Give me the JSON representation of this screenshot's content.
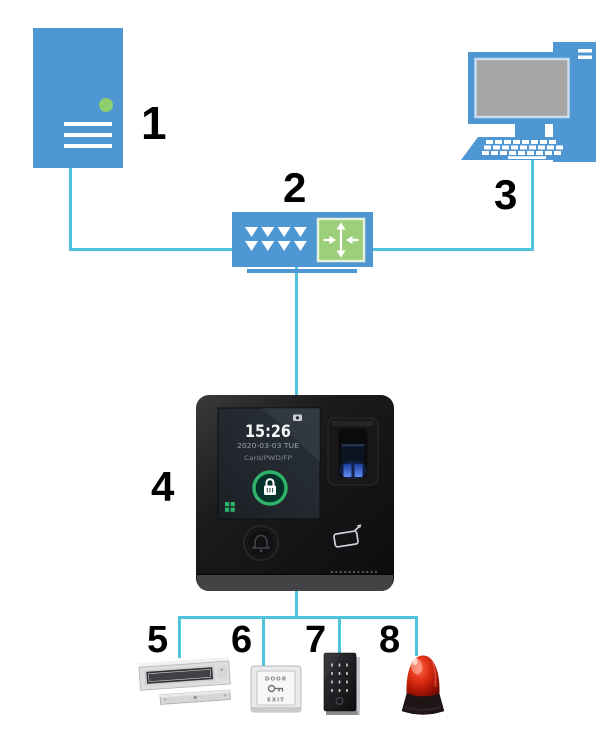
{
  "canvas": {
    "width": 608,
    "height": 733,
    "background_color": "#ffffff"
  },
  "palette": {
    "device_blue": "#4e97d3",
    "connector_cyan": "#4fc3dc",
    "accent_green": "#8fce6e",
    "switch_module_green": "#9ccf7a",
    "monitor_screen_gray": "#a6a6a6",
    "terminal_body_black": "#151517",
    "terminal_lock_ring_green": "#2eb46a",
    "fingerprint_glow_blue": "#4a7cf0",
    "siren_red": "#d42414",
    "number_label_color": "#000000"
  },
  "nodes": {
    "server": {
      "label": "1",
      "type": "server"
    },
    "switch": {
      "label": "2",
      "type": "network-switch"
    },
    "computer": {
      "label": "3",
      "type": "desktop-computer"
    },
    "terminal": {
      "label": "4",
      "type": "access-control-terminal",
      "screen": {
        "time": "15:26",
        "date": "2020-03-03  TUE",
        "auth_modes": "Card/PWD/FP"
      }
    },
    "lock": {
      "label": "5",
      "type": "magnetic-lock"
    },
    "exit_button": {
      "label": "6",
      "type": "exit-button",
      "text_top": "DOOR",
      "text_bottom": "EXIT"
    },
    "keypad": {
      "label": "7",
      "type": "card-reader-keypad"
    },
    "siren": {
      "label": "8",
      "type": "alarm-siren"
    }
  },
  "connections": [
    {
      "from": "server",
      "to": "switch"
    },
    {
      "from": "computer",
      "to": "switch"
    },
    {
      "from": "switch",
      "to": "terminal"
    },
    {
      "from": "terminal",
      "to": "lock"
    },
    {
      "from": "terminal",
      "to": "exit_button"
    },
    {
      "from": "terminal",
      "to": "keypad"
    },
    {
      "from": "terminal",
      "to": "siren"
    }
  ]
}
